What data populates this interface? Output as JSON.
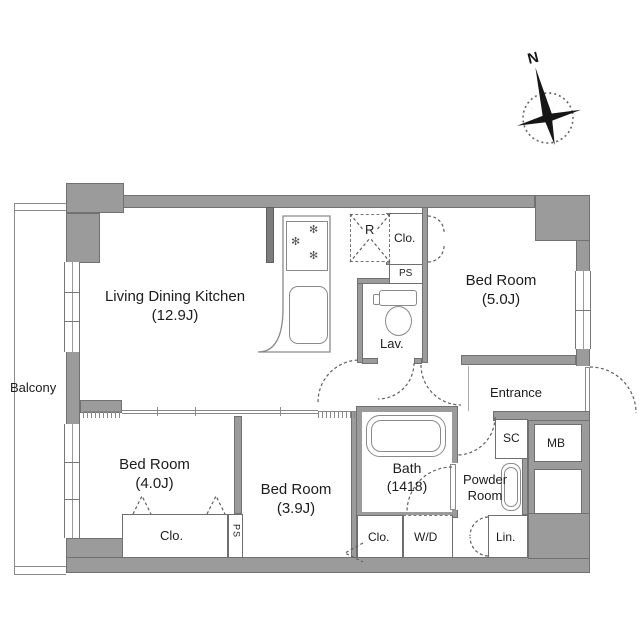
{
  "compass": {
    "north": "N"
  },
  "balcony": {
    "label": "Balcony"
  },
  "rooms": {
    "ldk": {
      "name": "Living Dining Kitchen",
      "size": "(12.9J)"
    },
    "bedroom_east": {
      "name": "Bed Room",
      "size": "(5.0J)"
    },
    "bedroom_west": {
      "name": "Bed Room",
      "size": "(4.0J)"
    },
    "bedroom_south": {
      "name": "Bed Room",
      "size": "(3.9J)"
    },
    "bath": {
      "name": "Bath",
      "size": "(1418)"
    },
    "lav": {
      "name": "Lav."
    },
    "powder_room": {
      "line1": "Powder",
      "line2": "Room"
    },
    "entrance": {
      "name": "Entrance"
    }
  },
  "storage": {
    "closet_north": "Clo.",
    "closet_west": "Clo.",
    "closet_south": "Clo.",
    "linen": "Lin.",
    "shoe_closet": "SC",
    "meter_box": "MB",
    "washer_dryer": "W/D",
    "refrigerator": "R",
    "pipe_space_north": "PS",
    "pipe_space_west": "PS"
  },
  "colors": {
    "wall": "#9b9b9b",
    "wall_dark": "#7d7d7d",
    "outline": "#717171",
    "line": "#888888",
    "text": "#1c1c1c"
  }
}
